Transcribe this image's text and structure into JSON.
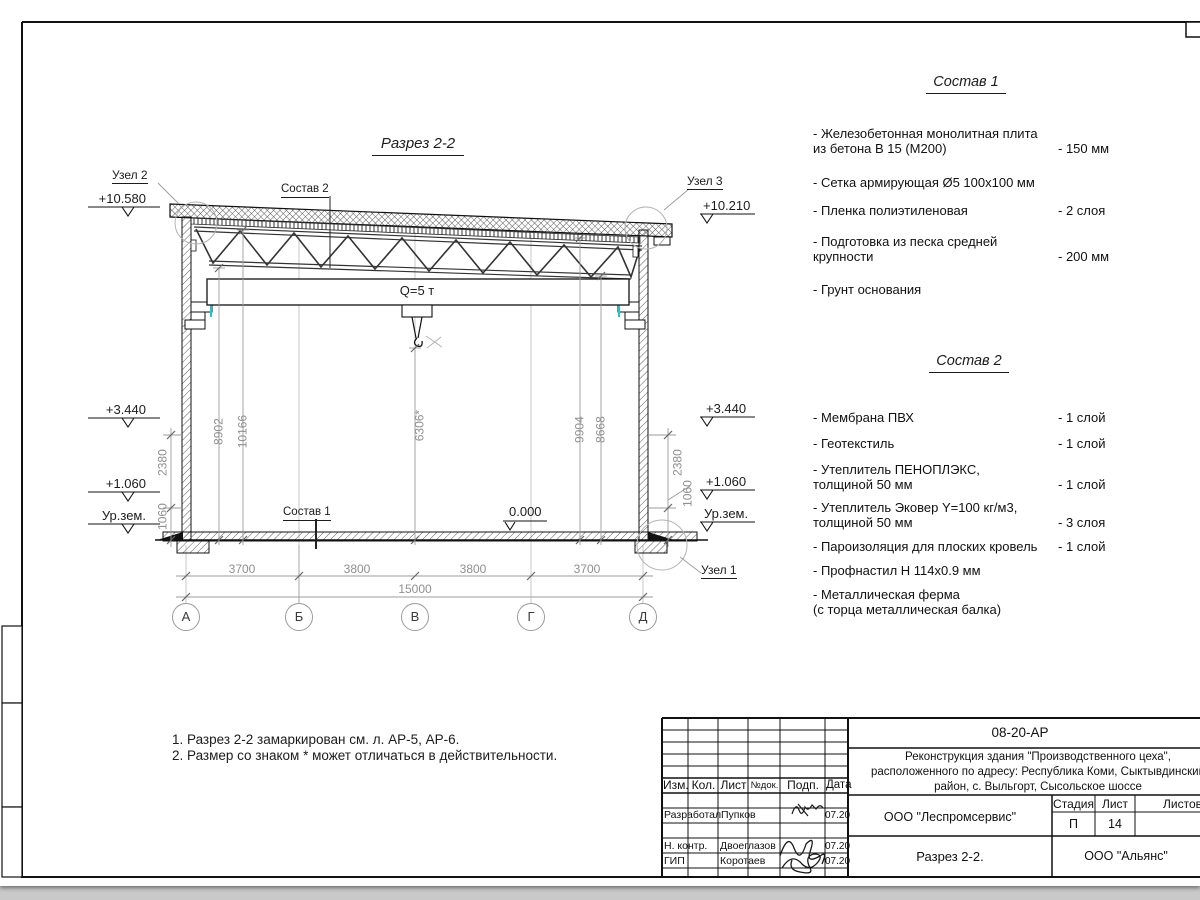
{
  "drawing": {
    "title": "Разрез 2-2",
    "crane_label": "Q=5 т",
    "zero_level": "0.000",
    "elev": {
      "left_top": "+10.580",
      "left_mid": "+3.440",
      "left_low": "+1.060",
      "left_ground": "Ур.зем.",
      "right_top": "+10.210",
      "right_mid": "+3.440",
      "right_low": "+1.060",
      "right_ground": "Ур.зем."
    },
    "callouts": {
      "uzel1": "Узел 1",
      "uzel2": "Узел 2",
      "uzel3": "Узел 3",
      "sostav1_ref": "Состав 1",
      "sostav2_ref": "Состав 2"
    },
    "vdim": {
      "d8902": "8902",
      "d10166": "10166",
      "d6306": "6306*",
      "d9904": "9904",
      "d8668": "8668",
      "left_2380": "2380",
      "left_1060": "1060",
      "right_2380": "2380",
      "right_1060": "1060"
    },
    "hdim": [
      "3700",
      "3800",
      "3800",
      "3700"
    ],
    "total_dim": "15000",
    "grid": [
      "А",
      "Б",
      "В",
      "Г",
      "Д"
    ]
  },
  "sostav1": {
    "title": "Состав 1",
    "items": [
      {
        "name": "- Железобетонная  монолитная плита\nиз бетона В 15 (М200)",
        "value": "- 150 мм"
      },
      {
        "name": "- Сетка армирующая Ø5 100х100 мм",
        "value": ""
      },
      {
        "name": "- Пленка полиэтиленовая",
        "value": "-  2 слоя"
      },
      {
        "name": "- Подготовка из песка средней\nкрупности",
        "value": "- 200 мм"
      },
      {
        "name": "- Грунт основания",
        "value": ""
      }
    ]
  },
  "sostav2": {
    "title": "Состав 2",
    "items": [
      {
        "name": "- Мембрана ПВХ",
        "value": "- 1 слой"
      },
      {
        "name": "- Геотекстиль",
        "value": "- 1 слой"
      },
      {
        "name": "- Утеплитель ПЕНОПЛЭКС,\nтолщиной 50 мм",
        "value": "- 1 слой"
      },
      {
        "name": "- Утеплитель Эковер Y=100 кг/м3,\nтолщиной 50 мм",
        "value": "- 3 слоя"
      },
      {
        "name": "- Пароизоляция для плоских кровель",
        "value": "- 1 слой"
      },
      {
        "name": "- Профнастил Н 114х0.9 мм",
        "value": ""
      },
      {
        "name": "- Металлическая ферма\n(с торца металлическая балка)",
        "value": ""
      }
    ]
  },
  "notes": {
    "n1": "1. Разрез 2-2 замаркирован см. л. АР-5, АР-6.",
    "n2": "2. Размер со знаком * может отличаться в действительности."
  },
  "titleblock": {
    "code": "08-20-АР",
    "project": "Реконструкция здания \"Производственного цеха\",\nрасположенного по адресу: Республика Коми, Сыктывдинский\nрайон, с. Выльгорт, Сысольское шоссе",
    "cols": {
      "izm": "Изм.",
      "kol": "Кол.",
      "list": "Лист",
      "ndok": "№док.",
      "podp": "Подп.",
      "data": "Дата"
    },
    "rows": [
      {
        "role": "Разработал",
        "name": "Пупков",
        "date": "07.20"
      },
      {
        "role": "Н. контр.",
        "name": "Двоеглазов",
        "date": "07.20"
      },
      {
        "role": "ГИП",
        "name": "Коротаев",
        "date": "07.20"
      }
    ],
    "org": "ООО \"Леспромсервис\"",
    "stage_h": "Стадия",
    "sheet_h": "Лист",
    "sheets_h": "Листов",
    "stage": "П",
    "sheet_no": "14",
    "sheet_title": "Разрез 2-2.",
    "org2": "ООО \"Альянс\""
  }
}
